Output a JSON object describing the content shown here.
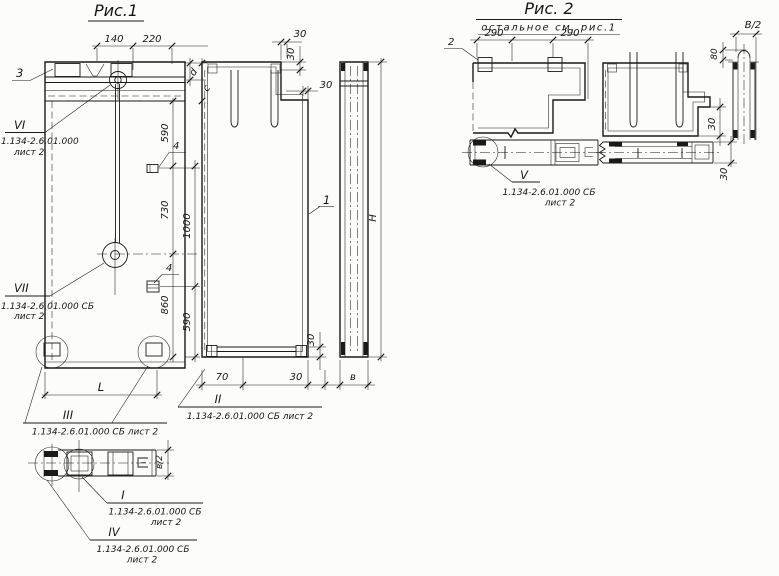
{
  "figure1": {
    "title": "Рис.1",
    "dims": {
      "w140": "140",
      "w220": "220",
      "d": "d",
      "c": "c",
      "v590_top": "590",
      "v730": "730",
      "v1000": "1000",
      "v860": "860",
      "v590_bot": "590",
      "len": "L",
      "h": "H",
      "b": "в",
      "b_half": "в/2",
      "s30_w": "30",
      "s30_t": "30",
      "s30_d": "30",
      "bot30_t": "30",
      "bot70": "70",
      "bot30": "30"
    },
    "callouts": {
      "p3": "3",
      "p1": "1",
      "p4a": "4",
      "p4b": "4",
      "VI": {
        "n": "VI",
        "doc": "1.134-2.6.01.000",
        "sheet": "лист 2"
      },
      "VII": {
        "n": "VII",
        "doc": "1.134-2.6.01.000 СБ",
        "sheet": "лист 2"
      },
      "III": {
        "n": "III",
        "doc": "1.134-2.6.01.000 СБ лист 2"
      },
      "II": {
        "n": "II",
        "doc": "1.134-2.6.01.000 СБ лист 2"
      },
      "I": {
        "n": "I",
        "doc": "1.134-2.6.01.000 СБ",
        "sheet": "лист 2"
      },
      "IV": {
        "n": "IV",
        "doc": "1.134-2.6.01.000 СБ",
        "sheet": "лист 2"
      }
    }
  },
  "figure2": {
    "title": "Рис. 2",
    "subtitle": "остальное см. рис.1",
    "dims": {
      "w290a": "290",
      "w290b": "290",
      "B_half": "В/2",
      "dome": "80",
      "t30a": "30",
      "t30b": "30"
    },
    "callouts": {
      "p2": "2",
      "V": {
        "n": "V",
        "doc": "1.134-2.6.01.000 СБ",
        "sheet": "лист 2"
      }
    }
  }
}
